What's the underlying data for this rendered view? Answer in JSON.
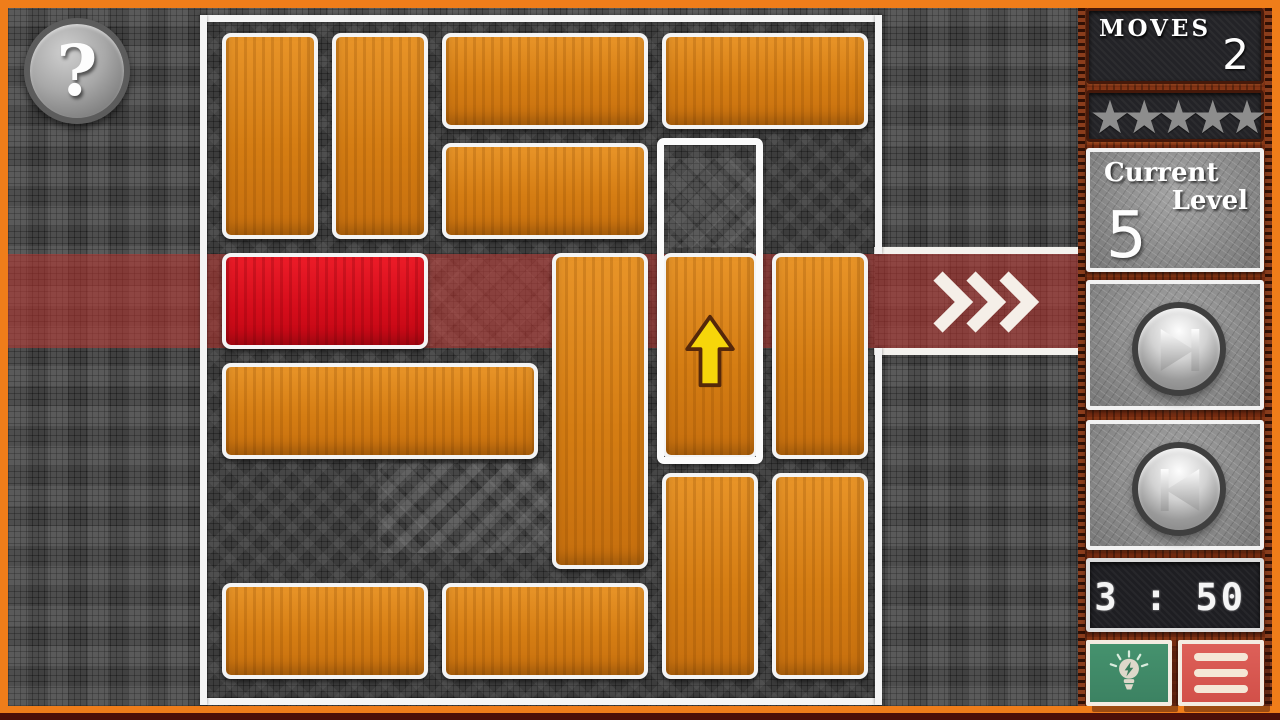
{
  "help": {
    "glyph": "?"
  },
  "board": {
    "cols": 6,
    "rows": 6,
    "exit": {
      "row": 2,
      "side": "right",
      "chevron_count": 3
    },
    "selection": {
      "col": 4,
      "row": 1,
      "w": 1,
      "h": 3
    },
    "blocks": [
      {
        "id": "b1",
        "col": 0,
        "row": 0,
        "w": 1,
        "h": 2,
        "type": "orange"
      },
      {
        "id": "b2",
        "col": 1,
        "row": 0,
        "w": 1,
        "h": 2,
        "type": "orange"
      },
      {
        "id": "b3",
        "col": 2,
        "row": 0,
        "w": 2,
        "h": 1,
        "type": "orange"
      },
      {
        "id": "b4",
        "col": 4,
        "row": 0,
        "w": 2,
        "h": 1,
        "type": "orange"
      },
      {
        "id": "b5",
        "col": 2,
        "row": 1,
        "w": 2,
        "h": 1,
        "type": "orange"
      },
      {
        "id": "red",
        "col": 0,
        "row": 2,
        "w": 2,
        "h": 1,
        "type": "red"
      },
      {
        "id": "b6",
        "col": 0,
        "row": 3,
        "w": 3,
        "h": 1,
        "type": "orange"
      },
      {
        "id": "b7",
        "col": 3,
        "row": 2,
        "w": 1,
        "h": 3,
        "type": "orange"
      },
      {
        "id": "b8",
        "col": 4,
        "row": 2,
        "w": 1,
        "h": 2,
        "type": "orange",
        "hint_arrow": "up"
      },
      {
        "id": "b9",
        "col": 5,
        "row": 2,
        "w": 1,
        "h": 2,
        "type": "orange"
      },
      {
        "id": "b10",
        "col": 4,
        "row": 4,
        "w": 1,
        "h": 2,
        "type": "orange"
      },
      {
        "id": "b11",
        "col": 5,
        "row": 4,
        "w": 1,
        "h": 2,
        "type": "orange"
      },
      {
        "id": "b12",
        "col": 0,
        "row": 5,
        "w": 2,
        "h": 1,
        "type": "orange"
      },
      {
        "id": "b13",
        "col": 2,
        "row": 5,
        "w": 2,
        "h": 1,
        "type": "orange"
      }
    ]
  },
  "sidebar": {
    "moves": {
      "label": "MOVES",
      "value": "2"
    },
    "stars": {
      "count": 5,
      "glyph": "★"
    },
    "level": {
      "label_top": "Current",
      "label_bottom": "Level",
      "value": "5"
    },
    "nav": {
      "next_icon": "skip-next",
      "prev_icon": "skip-previous"
    },
    "timer": {
      "value": "3 : 50"
    },
    "hint": {
      "icon": "lightbulb"
    },
    "menu": {
      "icon": "hamburger"
    }
  },
  "colors": {
    "frame_orange": "#ef7d1a",
    "block_orange": "#d57d13",
    "block_red": "#dc0f1e",
    "exit_band": "rgba(185,52,48,0.55)",
    "board_outline": "#f4f4f4",
    "wood": "#762c11",
    "hint_green": "#3f8a68",
    "menu_red": "#d65650",
    "hint_arrow_yellow": "#f6d60a",
    "star_gray": "#8d8d8d"
  }
}
